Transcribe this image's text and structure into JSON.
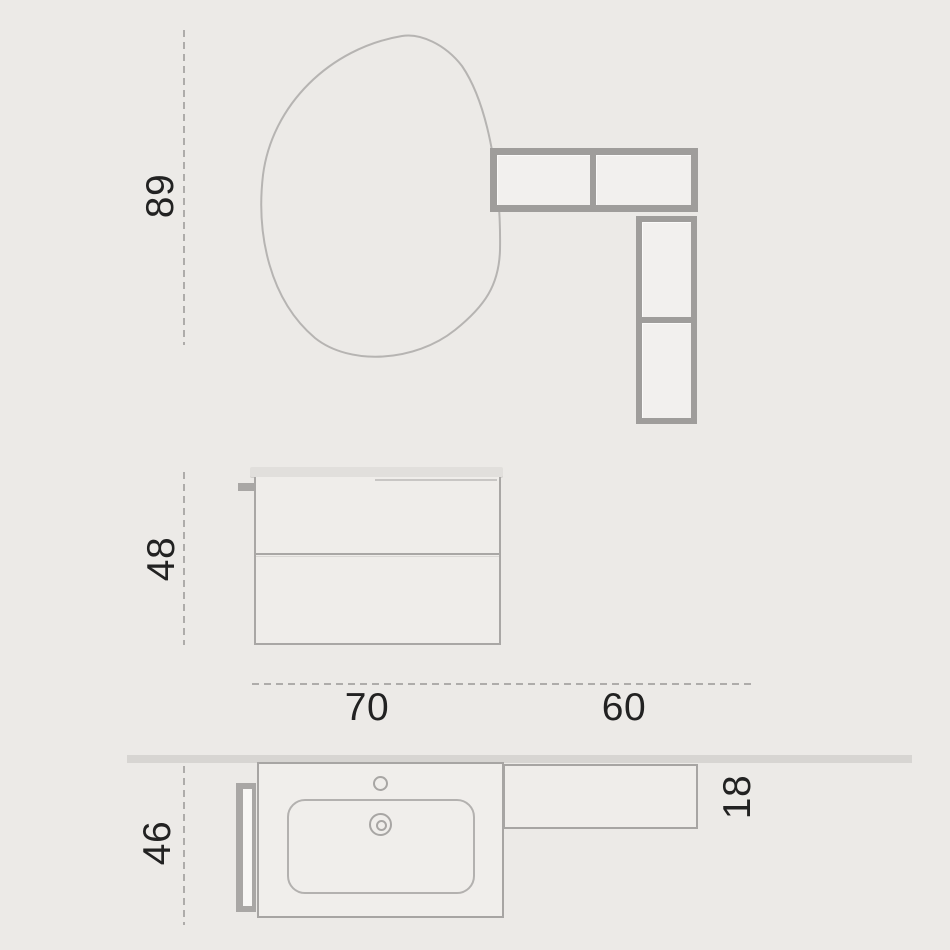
{
  "dimensions": {
    "mirror_height": {
      "value": "89",
      "orientation": "vertical"
    },
    "cabinet_height": {
      "value": "48",
      "orientation": "vertical"
    },
    "cabinet_width": {
      "value": "70",
      "orientation": "horizontal"
    },
    "side_unit_width": {
      "value": "60",
      "orientation": "horizontal"
    },
    "cabinet_depth": {
      "value": "46",
      "orientation": "vertical"
    },
    "shelf_depth": {
      "value": "18",
      "orientation": "vertical"
    }
  },
  "colors": {
    "background": "#ECEAE7",
    "outline_gray": "#A9A7A5",
    "shelf_frame_gray": "#9F9D9B",
    "light_fill": "#F2F0EE",
    "wall_band": "#D7D5D2",
    "mirror_stroke": "#B6B4B2",
    "dashed_guide": "#9A9896",
    "label_text": "#222222"
  }
}
